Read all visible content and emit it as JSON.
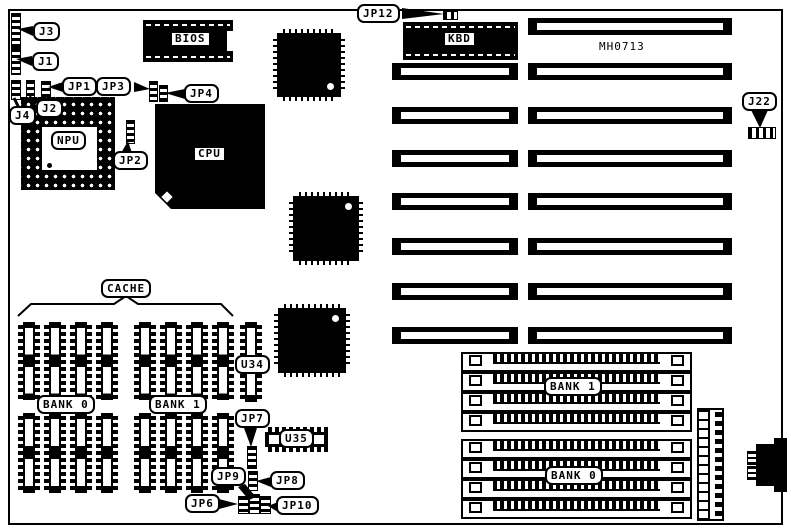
{
  "diagram": {
    "type": "motherboard-layout",
    "model_text": "MH0713"
  },
  "colors": {
    "ink": "#000000",
    "paper": "#ffffff"
  },
  "labels": {
    "j3": "J3",
    "j1": "J1",
    "jp1": "JP1",
    "jp3": "JP3",
    "jp4": "JP4",
    "j4": "J4",
    "j2": "J2",
    "jp2": "JP2",
    "npu": "NPU",
    "bios": "BIOS",
    "cpu": "CPU",
    "jp12": "JP12",
    "kbd": "KBD",
    "model": "MH0713",
    "j22": "J22",
    "cache": "CACHE",
    "cache_bank0": "BANK 0",
    "cache_bank1": "BANK 1",
    "u34": "U34",
    "jp7": "JP7",
    "u35": "U35",
    "jp9": "JP9",
    "jp8": "JP8",
    "jp6": "JP6",
    "jp10": "JP10",
    "simm_bank1": "BANK 1",
    "simm_bank0": "BANK 0"
  }
}
